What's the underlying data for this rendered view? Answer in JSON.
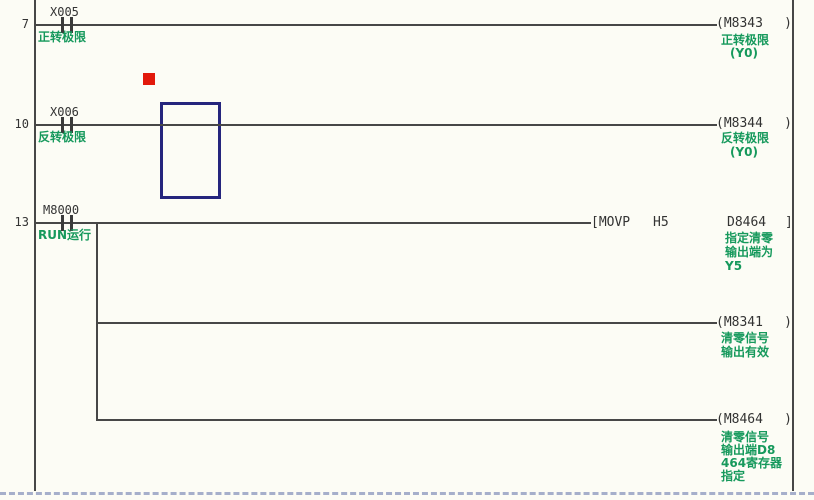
{
  "app": {
    "type": "plc-ladder-editor"
  },
  "symbols": {
    "coil_open": "(",
    "coil_close": ")",
    "instr_open": "[",
    "instr_close": "]"
  },
  "colors": {
    "background": "#fcfcf5",
    "wire": "#474747",
    "device_text": "#333333",
    "comment_green": "#16995c",
    "selection_cursor_blue": "#25257d",
    "edit_marker_red": "#e2190b",
    "page_break_line": "#8a96bd"
  },
  "rungs": [
    {
      "step": "7",
      "contact": {
        "device": "X005",
        "comment": "正转极限"
      },
      "coil": {
        "device": "M8343",
        "comment_lines": [
          "正转极限",
          "(Y0)"
        ]
      }
    },
    {
      "step": "10",
      "contact": {
        "device": "X006",
        "comment": "反转极限"
      },
      "coil": {
        "device": "M8344",
        "comment_lines": [
          "反转极限",
          "(Y0)"
        ]
      }
    },
    {
      "step": "13",
      "contact": {
        "device": "M8000",
        "comment": "RUN运行"
      },
      "instruction": {
        "opcode": "MOVP",
        "operand1": "H5",
        "operand2": "D8464",
        "comment_lines": [
          "指定清零",
          "输出端为",
          "Y5"
        ]
      },
      "branch_coils": [
        {
          "device": "M8341",
          "comment_lines": [
            "清零信号",
            "输出有效"
          ]
        },
        {
          "device": "M8464",
          "comment_lines": [
            "清零信号",
            "输出端D8",
            "464寄存器",
            "指定"
          ]
        }
      ]
    }
  ]
}
